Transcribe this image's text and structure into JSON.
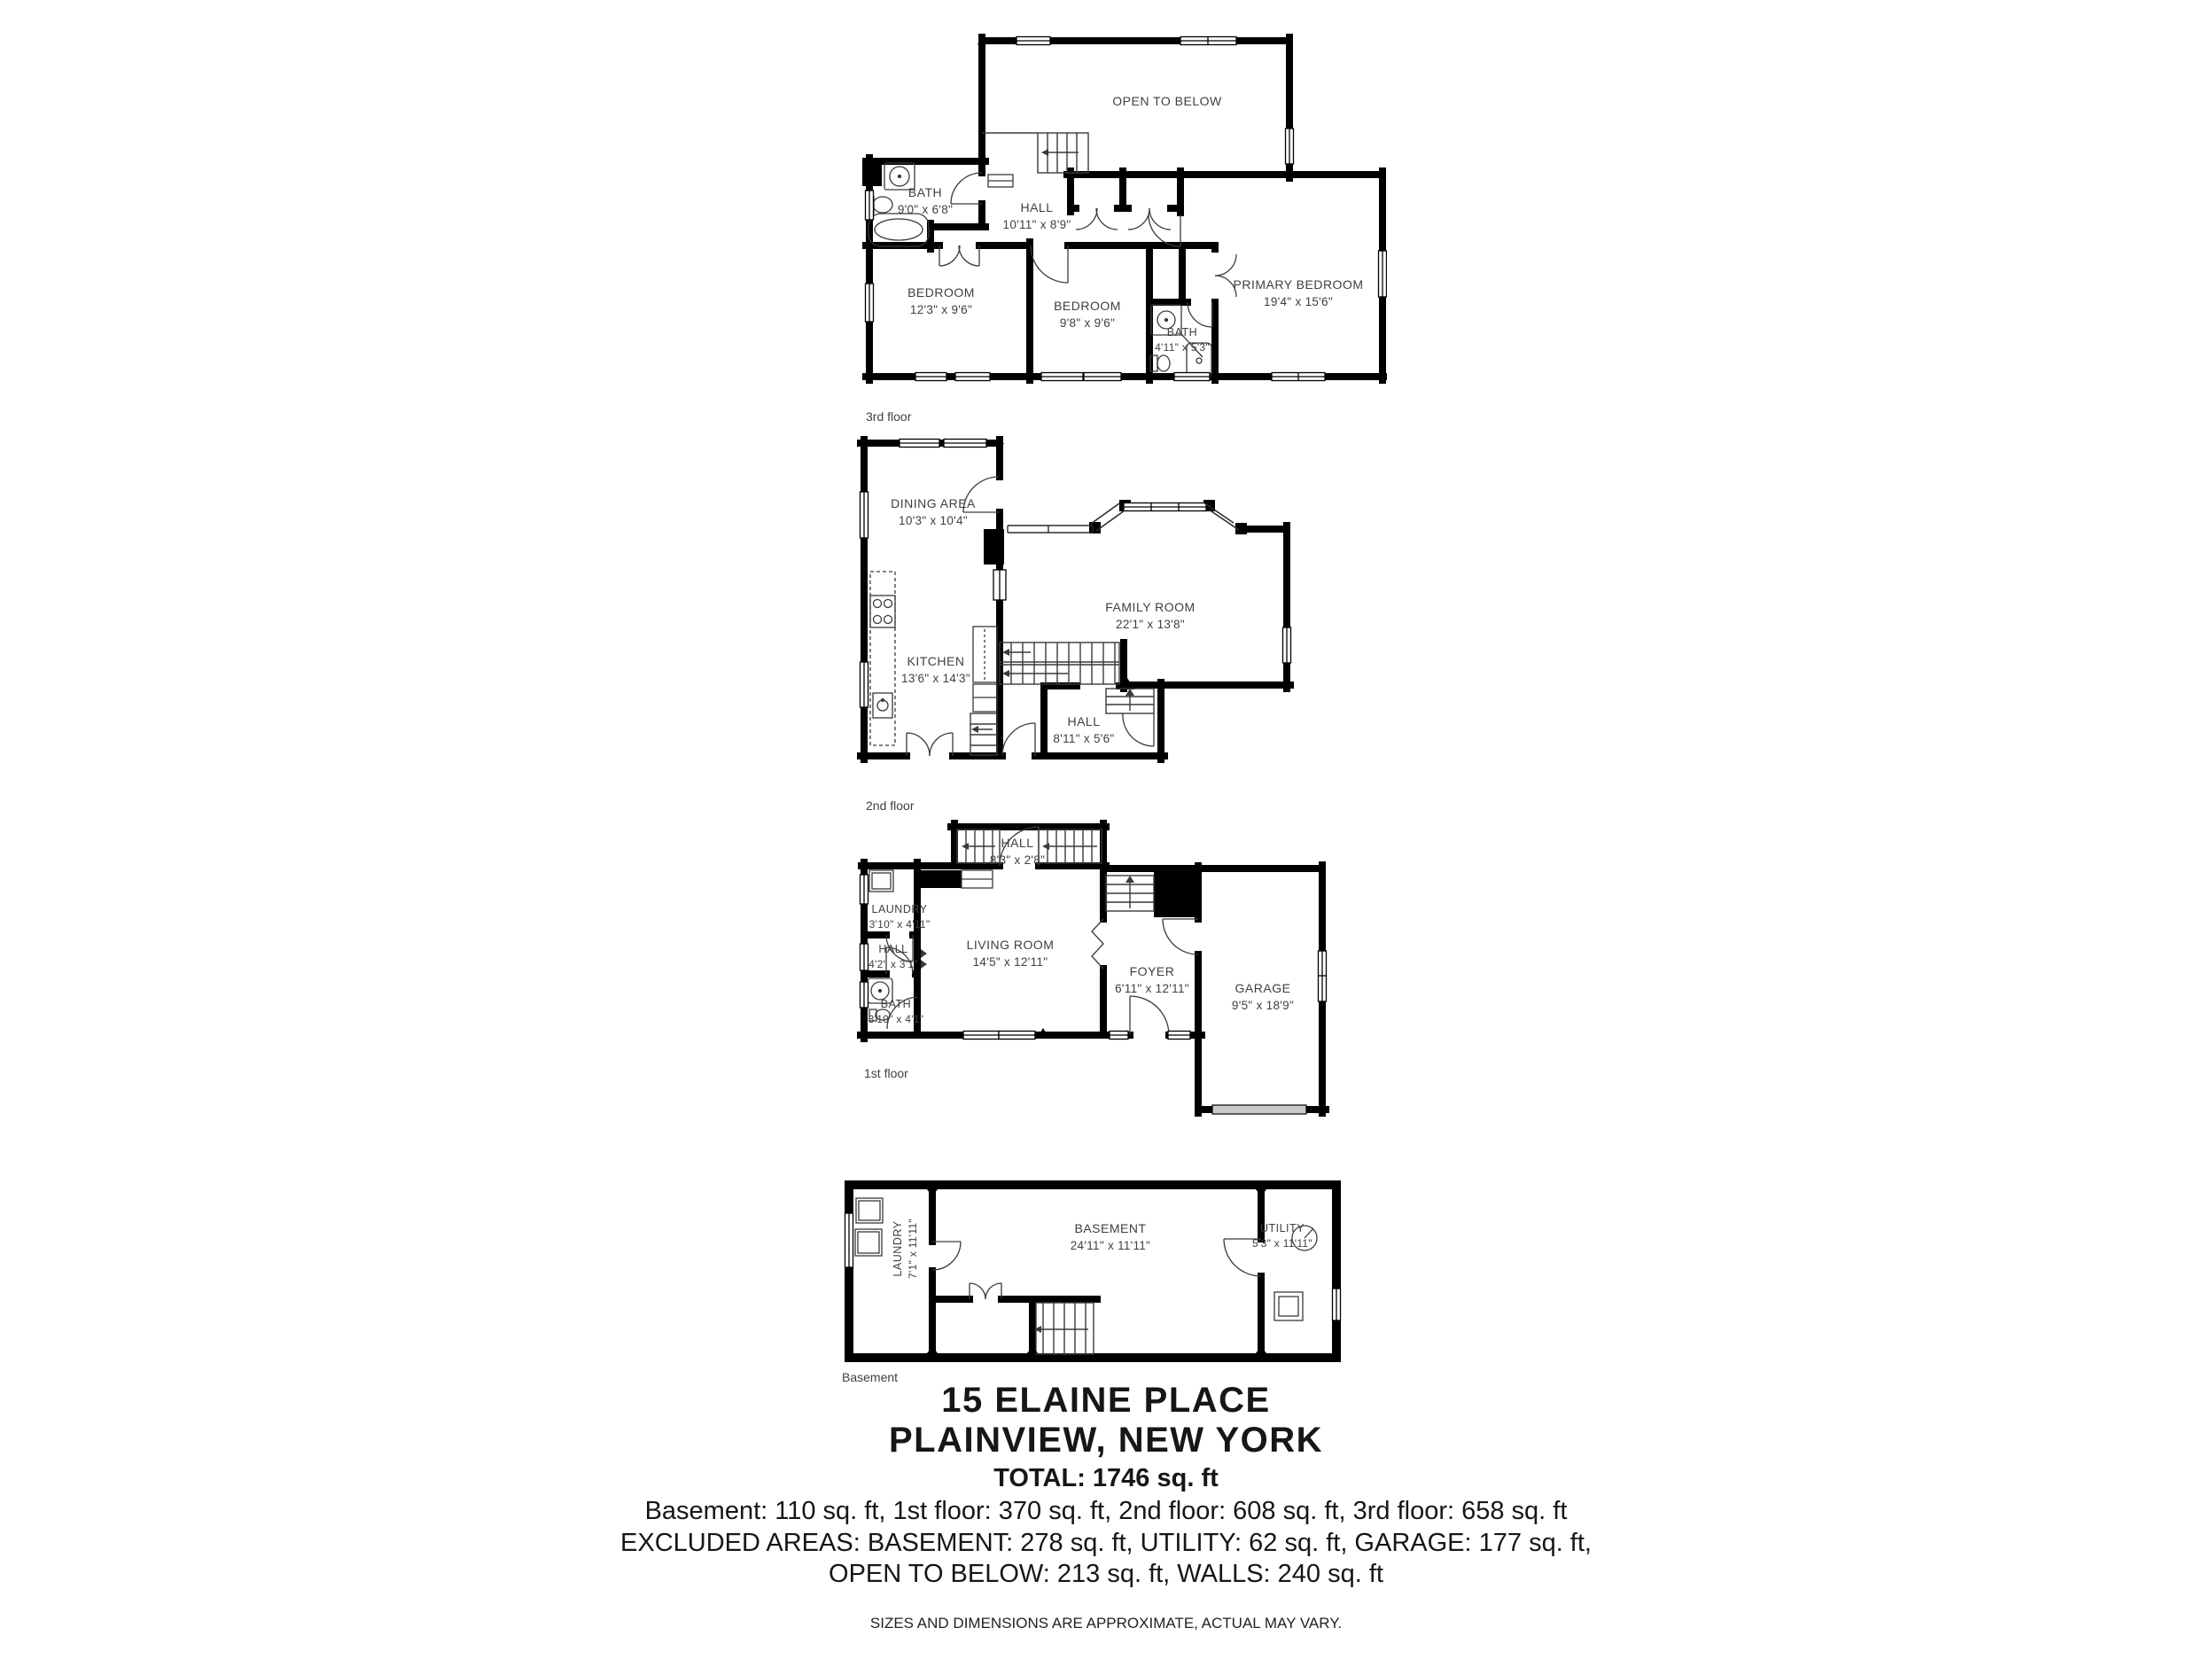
{
  "floors": [
    {
      "caption": "3rd floor",
      "rooms": [
        {
          "name": "OPEN TO BELOW",
          "dims": ""
        },
        {
          "name": "BATH",
          "dims": "9'0\" x 6'8\""
        },
        {
          "name": "HALL",
          "dims": "10'11\" x 8'9\""
        },
        {
          "name": "BEDROOM",
          "dims": "12'3\" x 9'6\""
        },
        {
          "name": "BEDROOM",
          "dims": "9'8\" x 9'6\""
        },
        {
          "name": "BATH",
          "dims": "4'11\" x 5'3\""
        },
        {
          "name": "PRIMARY BEDROOM",
          "dims": "19'4\" x 15'6\""
        }
      ]
    },
    {
      "caption": "2nd floor",
      "rooms": [
        {
          "name": "DINING AREA",
          "dims": "10'3\" x 10'4\""
        },
        {
          "name": "FAMILY ROOM",
          "dims": "22'1\" x 13'8\""
        },
        {
          "name": "KITCHEN",
          "dims": "13'6\" x 14'3\""
        },
        {
          "name": "HALL",
          "dims": "8'11\" x 5'6\""
        }
      ]
    },
    {
      "caption": "1st floor",
      "rooms": [
        {
          "name": "HALL",
          "dims": "8'3\" x 2'8\""
        },
        {
          "name": "LAUNDRY",
          "dims": "3'10\" x 4'11\""
        },
        {
          "name": "HALL",
          "dims": "4'2\" x 3'1\""
        },
        {
          "name": "BATH",
          "dims": "3'10\" x 4'1\""
        },
        {
          "name": "LIVING ROOM",
          "dims": "14'5\" x 12'11\""
        },
        {
          "name": "FOYER",
          "dims": "6'11\" x 12'11\""
        },
        {
          "name": "GARAGE",
          "dims": "9'5\" x 18'9\""
        }
      ]
    },
    {
      "caption": "Basement",
      "rooms": [
        {
          "name": "LAUNDRY",
          "dims": "7'1\" x 11'11\""
        },
        {
          "name": "BASEMENT",
          "dims": "24'11\" x 11'11\""
        },
        {
          "name": "UTILITY",
          "dims": "5'3\" x 11'11\""
        }
      ]
    }
  ],
  "footer": {
    "address_line1": "15 ELAINE PLACE",
    "address_line2": "PLAINVIEW, NEW YORK",
    "total": "TOTAL: 1746 sq. ft",
    "area_breakdown": "Basement: 110 sq. ft, 1st floor: 370 sq. ft, 2nd floor: 608 sq. ft, 3rd floor: 658 sq. ft",
    "excluded_line1": "EXCLUDED AREAS: BASEMENT: 278 sq. ft, UTILITY: 62 sq. ft, GARAGE: 177 sq. ft,",
    "excluded_line2": "OPEN TO BELOW: 213 sq. ft, WALLS: 240 sq. ft",
    "disclaimer": "SIZES AND DIMENSIONS ARE APPROXIMATE, ACTUAL MAY VARY."
  },
  "colors": {
    "wall": "#000000",
    "label_text": "#3f3f3f",
    "garage_door": "#c9c9c9"
  }
}
